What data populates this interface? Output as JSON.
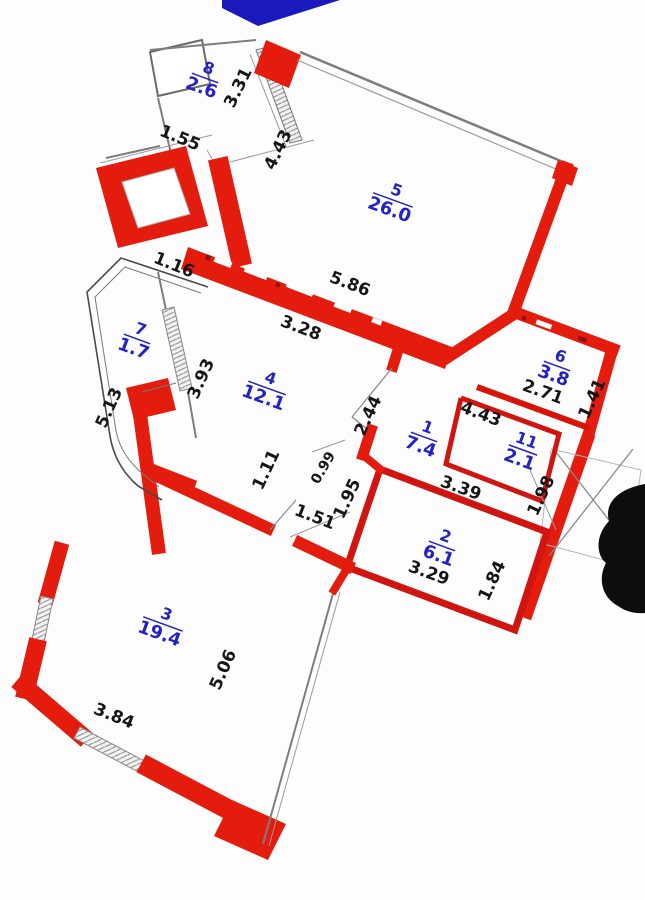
{
  "title": "Apartment floor plan",
  "rooms": {
    "r1": {
      "number": "1",
      "area": "7.4"
    },
    "r2": {
      "number": "2",
      "area": "6.1"
    },
    "r3": {
      "number": "3",
      "area": "19.4"
    },
    "r4": {
      "number": "4",
      "area": "12.1"
    },
    "r5": {
      "number": "5",
      "area": "26.0"
    },
    "r6": {
      "number": "6",
      "area": "3.8"
    },
    "r7": {
      "number": "7",
      "area": "1.7"
    },
    "r8": {
      "number": "8",
      "area": "2.6"
    },
    "r11": {
      "number": "11",
      "area": "2.1"
    }
  },
  "dimensions": {
    "d331": "3.31",
    "d155": "1.55",
    "d443_top": "4.43",
    "d586": "5.86",
    "d328": "3.28",
    "d116": "1.16",
    "d393": "3.93",
    "d513": "5.13",
    "d244": "2.44",
    "d111": "1.11",
    "d099": "0.99",
    "d151": "1.51",
    "d195": "1.95",
    "d443_hall": "4.43",
    "d339": "3.39",
    "d198": "1.98",
    "d271": "2.71",
    "d141": "1.41",
    "d184": "1.84",
    "d329": "3.29",
    "d506": "5.06",
    "d384": "3.84"
  },
  "colors": {
    "wall_red": "#e41c0e",
    "partition_red": "#d01410",
    "dim_text": "#161616",
    "room_label_blue": "#2323c4",
    "window_gray": "#8a8a8a",
    "annotation_blue": "#1a1abc",
    "redaction_black": "#0d0d0d"
  }
}
